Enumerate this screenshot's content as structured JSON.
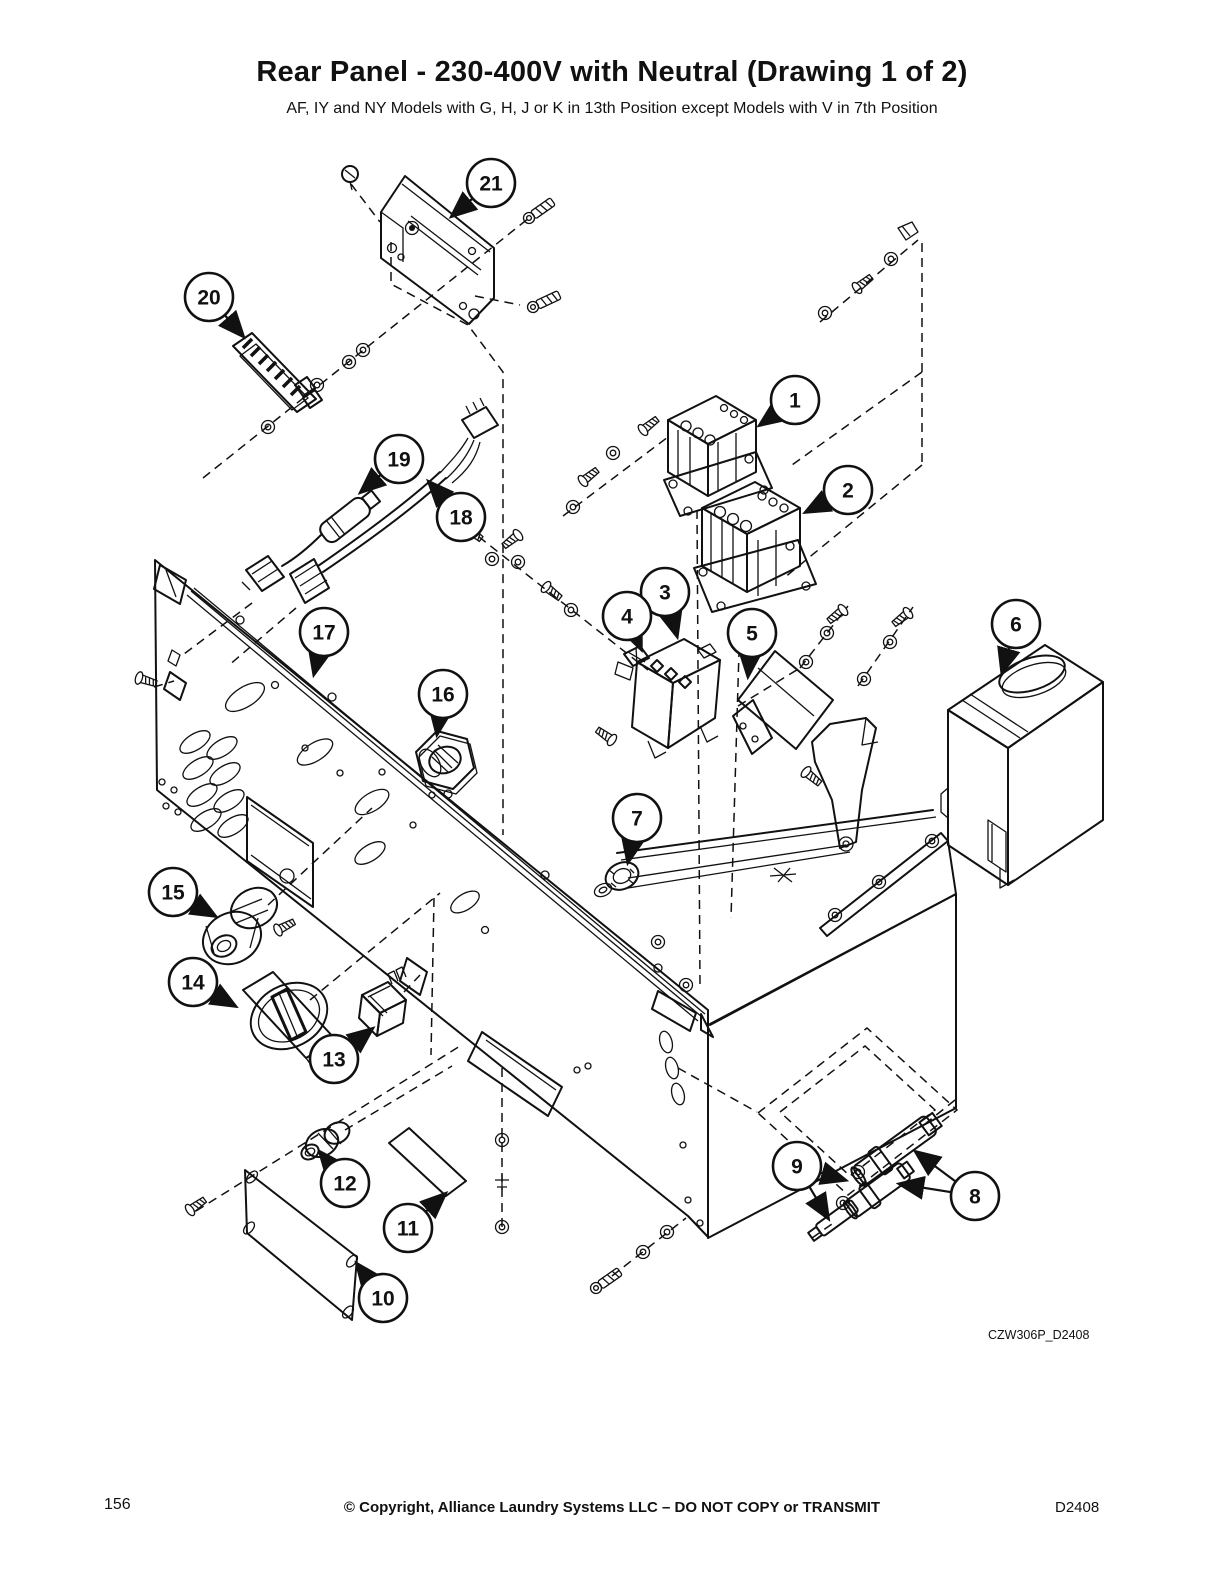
{
  "page": {
    "width": 1224,
    "height": 1584,
    "background": "#ffffff",
    "line_color": "#111111"
  },
  "header": {
    "title": "Rear Panel - 230-400V with Neutral (Drawing 1 of 2)",
    "subtitle": "AF, IY and NY Models with G, H, J or K in 13th Position except Models with V in 7th Position"
  },
  "figure": {
    "caption": "CZW306P_D2408",
    "description": "Exploded isometric parts diagram of rear panel assembly with numbered callouts",
    "callouts": [
      {
        "n": "1",
        "cx": 795,
        "cy": 400,
        "arrows": [
          [
            760,
            425
          ]
        ]
      },
      {
        "n": "2",
        "cx": 848,
        "cy": 490,
        "arrows": [
          [
            806,
            512
          ]
        ]
      },
      {
        "n": "3",
        "cx": 665,
        "cy": 592,
        "arrows": [
          [
            677,
            636
          ]
        ]
      },
      {
        "n": "4",
        "cx": 627,
        "cy": 616,
        "arrows": [
          [
            641,
            649
          ]
        ]
      },
      {
        "n": "5",
        "cx": 752,
        "cy": 633,
        "arrows": [
          [
            748,
            676
          ]
        ]
      },
      {
        "n": "6",
        "cx": 1016,
        "cy": 624,
        "arrows": [
          [
            1002,
            672
          ]
        ]
      },
      {
        "n": "7",
        "cx": 637,
        "cy": 818,
        "arrows": [
          [
            628,
            862
          ]
        ]
      },
      {
        "n": "8",
        "cx": 975,
        "cy": 1196,
        "arrows": [
          [
            916,
            1152
          ],
          [
            900,
            1184
          ]
        ]
      },
      {
        "n": "9",
        "cx": 797,
        "cy": 1166,
        "arrows": [
          [
            845,
            1180
          ],
          [
            828,
            1218
          ]
        ]
      },
      {
        "n": "10",
        "cx": 383,
        "cy": 1298,
        "arrows": [
          [
            357,
            1264
          ]
        ]
      },
      {
        "n": "11",
        "cx": 408,
        "cy": 1228,
        "arrows": [
          [
            445,
            1194
          ]
        ]
      },
      {
        "n": "12",
        "cx": 345,
        "cy": 1183,
        "arrows": [
          [
            320,
            1152
          ]
        ]
      },
      {
        "n": "13",
        "cx": 334,
        "cy": 1059,
        "arrows": [
          [
            372,
            1029
          ]
        ]
      },
      {
        "n": "14",
        "cx": 193,
        "cy": 982,
        "arrows": [
          [
            235,
            1006
          ]
        ]
      },
      {
        "n": "15",
        "cx": 173,
        "cy": 892,
        "arrows": [
          [
            215,
            916
          ]
        ]
      },
      {
        "n": "16",
        "cx": 443,
        "cy": 694,
        "arrows": [
          [
            437,
            734
          ]
        ]
      },
      {
        "n": "17",
        "cx": 324,
        "cy": 632,
        "arrows": [
          [
            314,
            674
          ]
        ]
      },
      {
        "n": "18",
        "cx": 461,
        "cy": 517,
        "arrows": [
          [
            429,
            482
          ]
        ]
      },
      {
        "n": "19",
        "cx": 399,
        "cy": 459,
        "arrows": [
          [
            361,
            492
          ]
        ]
      },
      {
        "n": "20",
        "cx": 209,
        "cy": 297,
        "arrows": [
          [
            243,
            336
          ]
        ]
      },
      {
        "n": "21",
        "cx": 491,
        "cy": 183,
        "arrows": [
          [
            452,
            216
          ]
        ]
      }
    ]
  },
  "footer": {
    "page_number": "156",
    "copyright": "© Copyright, Alliance Laundry Systems LLC – DO NOT COPY or TRANSMIT",
    "doc_code": "D2408"
  }
}
